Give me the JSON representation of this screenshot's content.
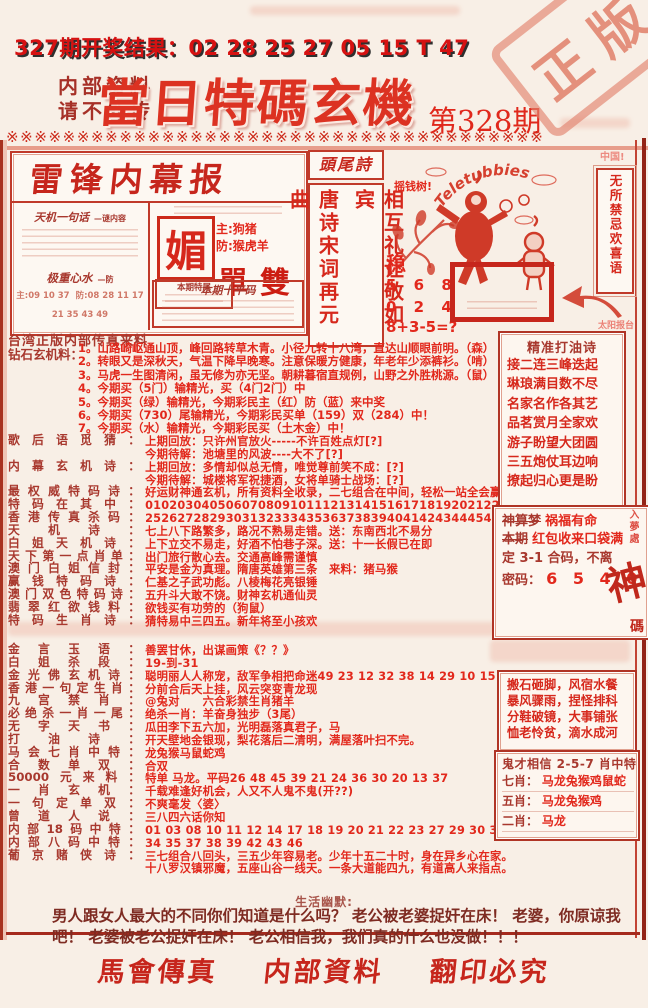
{
  "colors": {
    "accent": "#e2281c",
    "label": "#a8382e",
    "dark_text": "#7e2b22",
    "border": "#c03a2a"
  },
  "header": {
    "result_line": "327期开奖结果：02 28 25 27 05 15 T 47",
    "secret1": "内部资料",
    "secret2": "请不外传",
    "title": "當日特碼玄機",
    "issue": "第328期",
    "stamp": "正版",
    "separator": "※※※※※※※※※※※※※※※※※※※※※※※※※※※※※※※※※※※※※※"
  },
  "masthead": {
    "title": "雷锋内幕报",
    "tianji_label": "天机一句话",
    "tianji_sub": "—谜内容",
    "heavy_label": "极重心水",
    "heavy_sub": "—防",
    "heavy_zhu": "主:09 10 37",
    "heavy_fang": "防:08 28 11 17",
    "heavy_row2": "21 35 43 49",
    "mei": "媚",
    "zhu_line": "主:狗猪",
    "fang_line": "防:猴虎羊",
    "danshuang": "單雙",
    "tail_box_label": "本期特尾",
    "ten_label": "本期十平码"
  },
  "head_tail_poem": {
    "header": "頭尾詩",
    "col_left": "唐诗宋词再元曲",
    "col_right": "相互礼让敬如宾"
  },
  "artwork": {
    "money_tree": "摇钱树!",
    "brand": "Teletubbies",
    "stable": "稳",
    "row1": "5 6 8",
    "row2": "0 2 4",
    "formula": "8+3-5=?",
    "china": "中国!",
    "happy": "无所禁忌欢喜语",
    "sun_note": "太阳报台"
  },
  "source_line": "台湾正版内部传真来料",
  "diamond": {
    "label": "钻石玄机料：",
    "items": [
      "1。山路崎岖通山顶，峰回路转草木青。小径九转十八湾，直达山顺眼前明。（森）",
      "2。转眼又是深秋天，气温下降早晚寒。注意保暖方健康，年老年少添裤衫。（啃）",
      "3。马虎一生图清闲，虽无修为亦无坚。朝耕暮宿直规例，山野之外胜桃源。（鼠）",
      "4。今期买（5门）输精光，买（4门2门）中",
      "5。今期买（绿）输精光，今期彩民主（红）防（蓝）来中奖",
      "6。今期买（730）尾输精光，今期彩民买单（159）双（284）中！",
      "7。今期买（水）输精光，今期彩民买（土木金）中！"
    ]
  },
  "lines1": [
    {
      "label": "歌后语觅猜：",
      "text": "上期回放：只许州官放火-----不许百姓点灯[?]"
    },
    {
      "label": "",
      "text": "今期待解：池塘里的风波----大不了[?]"
    },
    {
      "label": "内幕玄机诗：",
      "text": "上期回放：多情却似总无情，唯觉尊前笑不成：[?]"
    },
    {
      "label": "",
      "text": "今期待解：城楼将军祝捷酒，女将单骑士战场：[?]"
    },
    {
      "label": "最权威特码诗：",
      "text": "好运财神通玄机，所有资料全收录，二七组合在中间，轻松一站全会赢"
    },
    {
      "label": "特码在其中：",
      "text": "010203040506070809101112131415161718192021222324"
    },
    {
      "label": "香港传真杀码：",
      "text": "25262728293031323334353637383940414243444546474849"
    },
    {
      "label": "天机诗：",
      "text": "七上八下路繁多，路况不熟易走错。送：东南西北不易分"
    },
    {
      "label": "白姐天机诗：",
      "text": "上下立交不易走，好酒不怕巷子深。送：十一长假已在即"
    },
    {
      "label": "天下第一点肖单：",
      "text": "出门旅行散心去。交通高峰需谨慎"
    },
    {
      "label": "澳门白姐信封：",
      "text": "平安是金为真理。隋唐英雄第三条　来料：猪马猴"
    },
    {
      "label": "赢钱特码诗：",
      "text": "仁基之子武功彪。八棱梅花亮银锤"
    },
    {
      "label": "澳门双色特码诗：",
      "text": "五升斗大敢不饶。财神玄机通仙灵"
    },
    {
      "label": "翡翠红欲钱料：",
      "text": "欲钱买有功劳的（狗鼠）"
    },
    {
      "label": "特码生肖诗：",
      "text": "猜特易中三四五。新年将至小孩欢"
    }
  ],
  "oil_box": {
    "title": "精准打油诗",
    "lines": [
      "接二连三峰迭起",
      "琳琅满目数不尽",
      "名家名作各其艺",
      "品茗赏月全家欢",
      "游子盼望大团圆",
      "三五炮仗耳边响",
      "撩起归心更是盼"
    ]
  },
  "dream_box": {
    "l1a": "神算梦",
    "l1b": "祸福有命",
    "l2a": "本期",
    "l2b": "红包收来口袋满",
    "l3": "定 3-1 合码，不离",
    "l4a": "密码：",
    "l4b": "6 5 4 0",
    "corner": "入夢處",
    "big": "神",
    "ma": "碼"
  },
  "idiom_box": {
    "lines": [
      "搬石砸脚，风宿水餐",
      "暴风骤雨，捏怪排科",
      "分鞋破镜，大事铺张",
      "恤老怜贫，滴水成河"
    ]
  },
  "ghost_box": {
    "title": "鬼才相信 2-5-7 肖中特",
    "rows": [
      {
        "label": "七肖：",
        "text": "马龙兔猴鸡鼠蛇"
      },
      {
        "label": "五肖：",
        "text": "马龙兔猴鸡"
      },
      {
        "label": "二肖：",
        "text": "马龙"
      }
    ]
  },
  "lines2": [
    {
      "label": "金言玉语：",
      "text": "善罢甘休，出谋画策《？？》"
    },
    {
      "label": "白姐杀段：",
      "text": "19-到-31"
    },
    {
      "label": "金光佛玄机诗：",
      "text": "聪明丽人人称宠，敌军争相把命迷49 23 12 32 38 14 29 10 15 09 06"
    },
    {
      "label": "香港一句定生肖：",
      "text": "分前合后天上挂，风云突变青龙现"
    },
    {
      "label": "九宫禁肖：",
      "text": "@兔对　　六合彩禁生肖猪羊"
    },
    {
      "label": "必绝杀一肖一尾：",
      "text": "绝杀一肖：羊奋身独步（3尾）"
    },
    {
      "label": "无字天书：",
      "text": "瓜田李下五六加，光明磊落真君子，马"
    },
    {
      "label": "打油诗：",
      "text": "开天壁地金银现，梨花落后二清明，满屋落叶扫不完。"
    },
    {
      "label": "马会七肖中特：",
      "text": "龙兔猴马鼠蛇鸡"
    },
    {
      "label": "合数单双：",
      "text": "合双"
    },
    {
      "label": "50000元来料：",
      "text": "特单 马龙。平码26 48 45 39 21 24 36 30 20 13 37"
    },
    {
      "label": "一肖玄机：",
      "text": "千载难逢好机会，人又不人鬼不鬼(开??)"
    },
    {
      "label": "一句定单双：",
      "text": "不爽毫发〈婆〉"
    },
    {
      "label": "曾道人说：",
      "text": "三八四六话你知"
    },
    {
      "label": "内部18码中特：",
      "text": "01 03 08 10 11 12 14 17 18 19 20 21 22 23 27 29 30 31"
    },
    {
      "label": "内部八码中特：",
      "text": "34 35 37 38 39 42 43 46"
    },
    {
      "label": "葡京赌侠诗：",
      "text": "三七组合八回头，三五少年容易老。少年十五二十时，身在异乡心在家。"
    },
    {
      "label": "",
      "text": "十八罗汉镇邪魔，五座山谷一线天。一条大道能四九，有道高人来指点。"
    }
  ],
  "humor": {
    "title": "生活幽默:",
    "text": "男人跟女人最大的不同你们知道是什么吗？ 老公被老婆捉奸在床！ 老婆，你原谅我吧！ 老婆被老公捉奸在床！ 老公相信我，我们真的什么也没做！！！"
  },
  "footer": {
    "a": "馬會傳真",
    "b": "内部資料",
    "c": "翻印必究"
  }
}
